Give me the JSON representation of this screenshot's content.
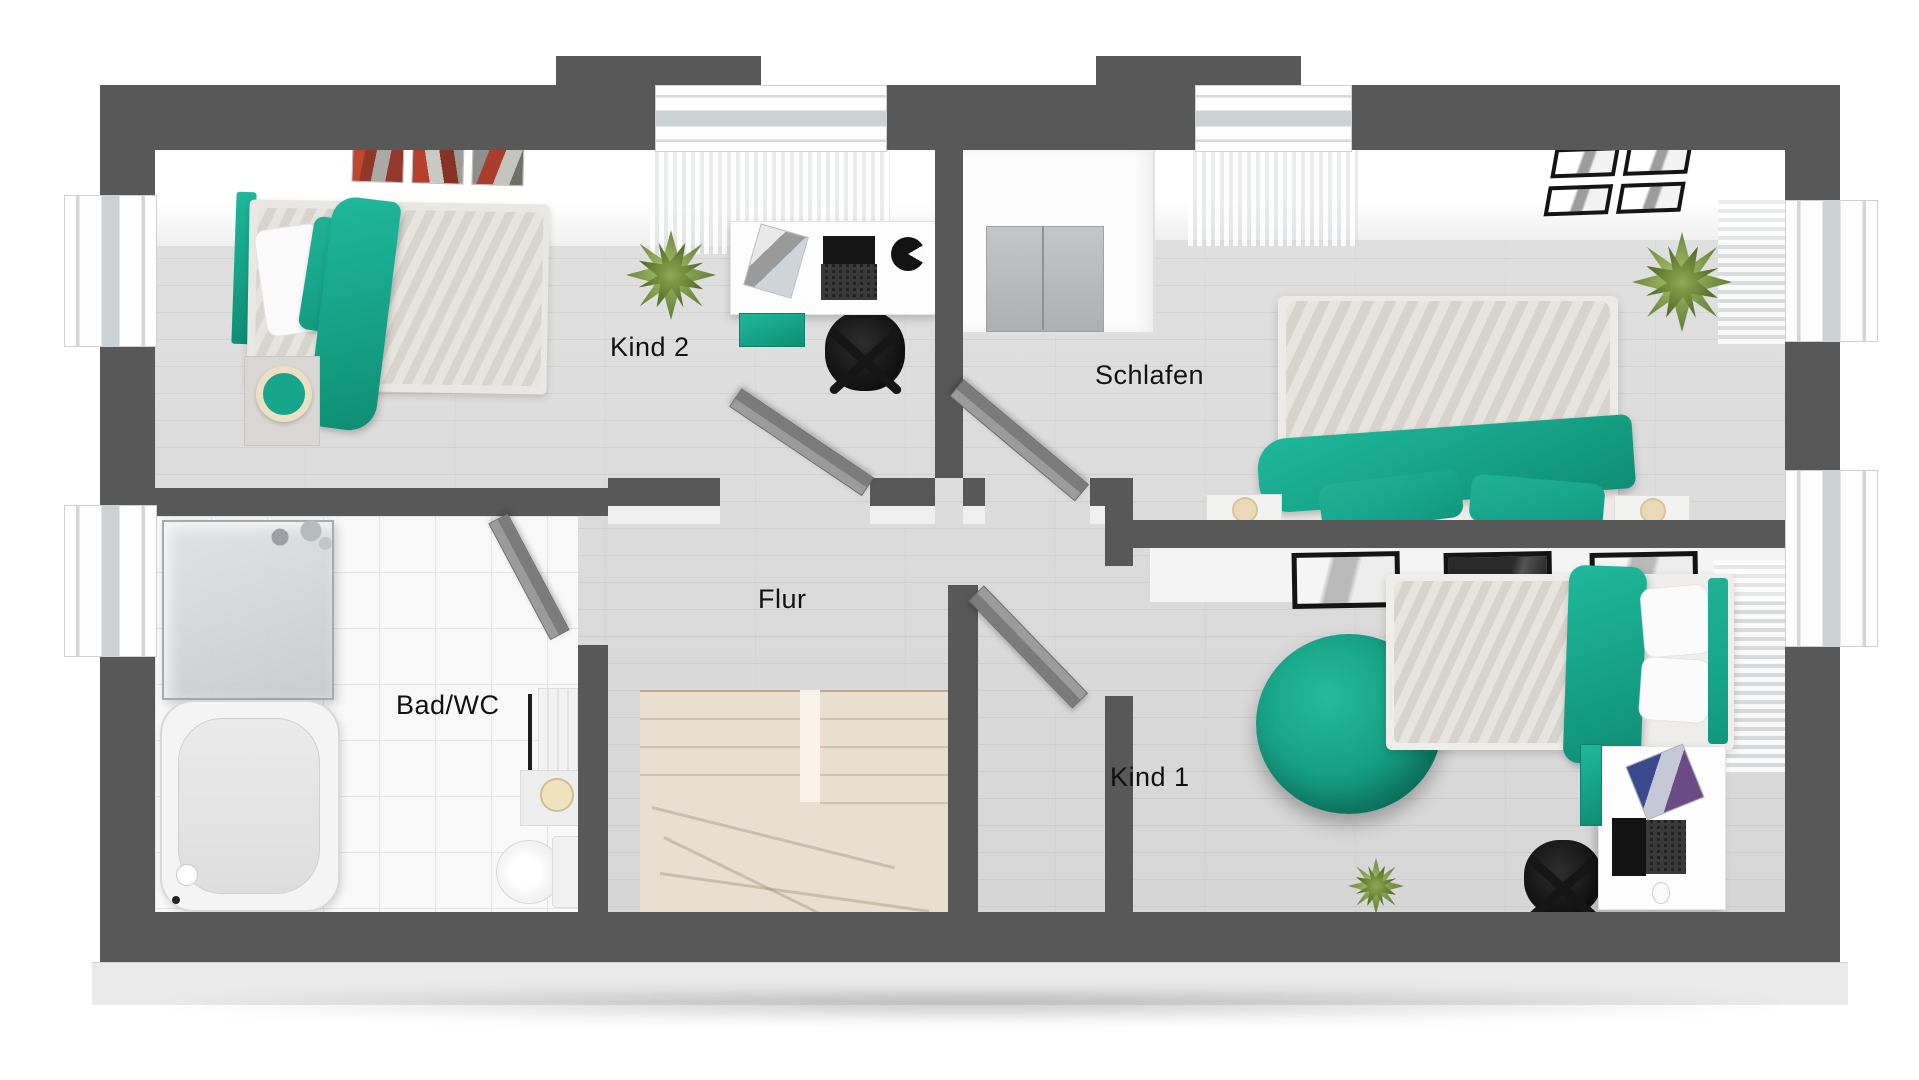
{
  "plan": {
    "rooms": [
      {
        "name": "kind-2",
        "label": "Kind 2"
      },
      {
        "name": "schlafen",
        "label": "Schlafen"
      },
      {
        "name": "flur",
        "label": "Flur"
      },
      {
        "name": "bad-wc",
        "label": "Bad/WC"
      },
      {
        "name": "kind-1",
        "label": "Kind 1"
      }
    ]
  },
  "colors": {
    "accent_teal": "#17a68b",
    "accent_teal_dark": "#0e8a70",
    "wall_dark": "#585858",
    "stair_beige": "#e9dfd1"
  }
}
